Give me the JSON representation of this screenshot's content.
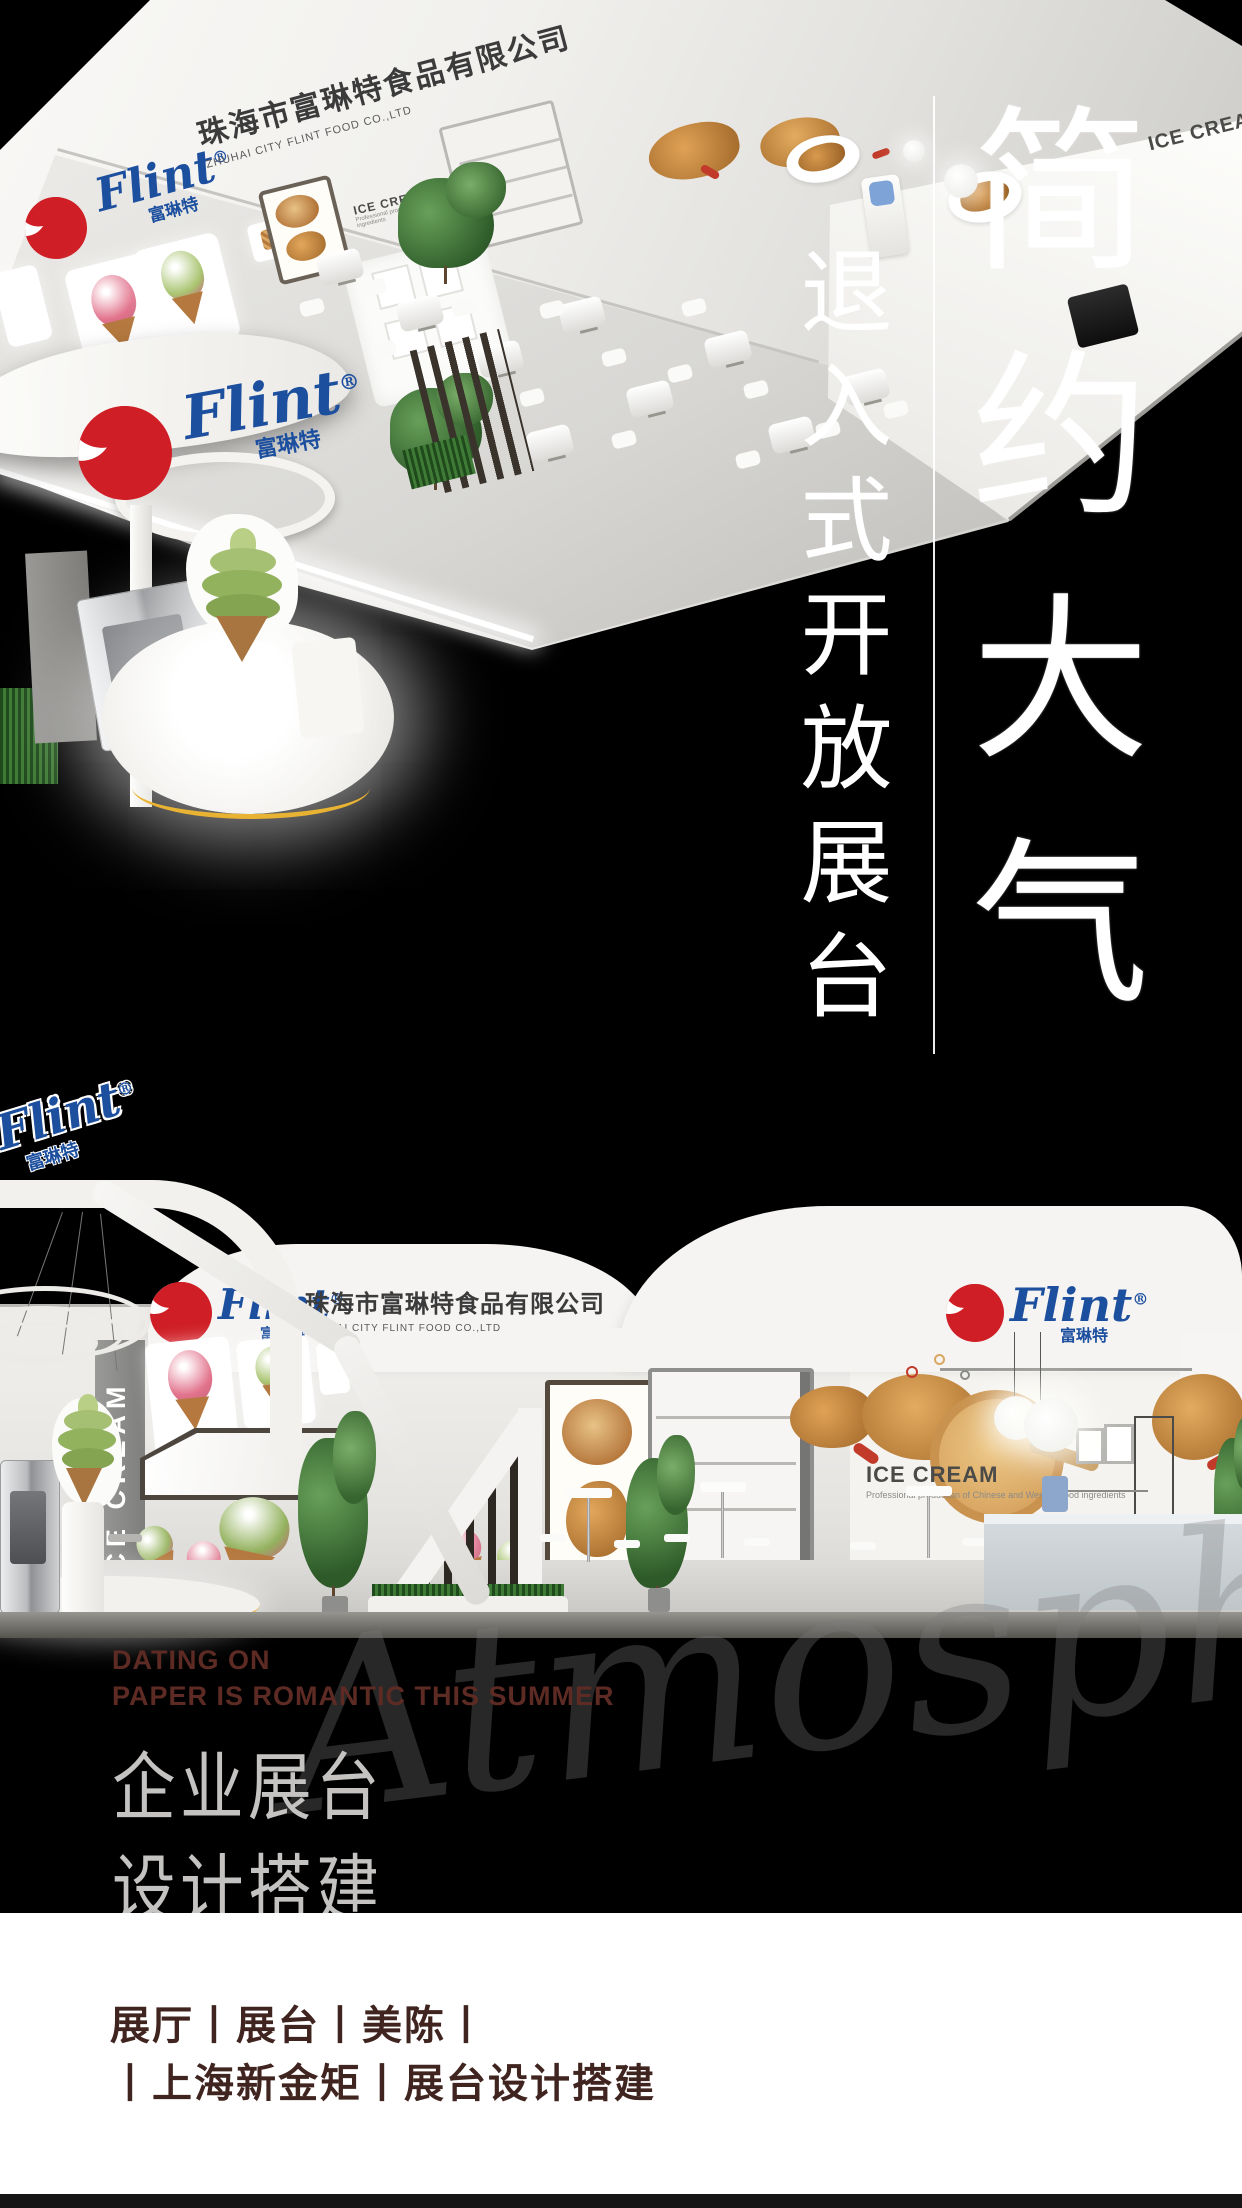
{
  "brand": {
    "script": "Flint",
    "reg": "®",
    "cn": "富琳特"
  },
  "company": {
    "cn": "珠海市富琳特食品有限公司",
    "en": "ZHUHAI CITY FLINT FOOD CO.,LTD"
  },
  "signs": {
    "ice_cream": "ICE CREAM",
    "ice_cream_sub": "Professional production of Chinese and Western food ingredients"
  },
  "headline": {
    "main": "简约大气",
    "sub": "退入式开放展台"
  },
  "captions": {
    "en1": "DATING ON",
    "en2": "PAPER IS ROMANTIC THIS SUMMER",
    "cn1": "企业展台",
    "cn2": "设计搭建",
    "watermark": "Atmosphere"
  },
  "footer": {
    "line1": "展厅丨展台丨美陈丨",
    "line2": "丨上海新金矩丨展台设计搭建"
  },
  "colors": {
    "flint_red": "#cf1e25",
    "flint_blue": "#1d4f9f",
    "caption_red": "#5e2b24",
    "caption_gray": "#c4c3c1",
    "footer_text": "#40241f",
    "footer_bg": "#ffffff",
    "accent_yellow": "#e8b233"
  }
}
